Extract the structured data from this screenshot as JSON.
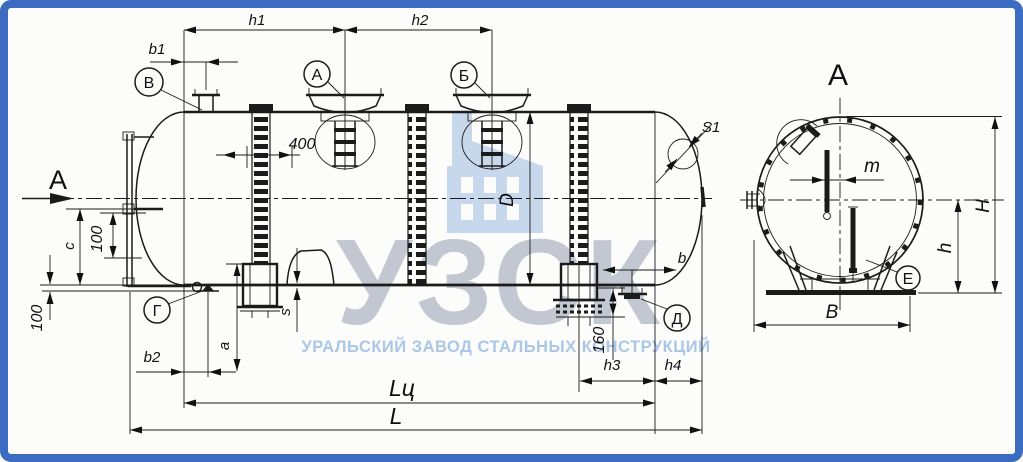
{
  "frame": {
    "border_color": "#3c6cc1",
    "background": "#fcfcfa"
  },
  "watermark": {
    "brand": "УЗСК",
    "tagline": "УРАЛЬСКИЙ ЗАВОД СТАЛЬНЫХ КОНСТРУКЦИЙ",
    "brand_color": "#c2c7d1",
    "tagline_color": "#aac7e7",
    "icon": "factory-icon",
    "icon_color": "#c8d8ec"
  },
  "side_view": {
    "section_arrow_label": "А",
    "callouts": {
      "nozzle_top": "В",
      "manhole_left": "А",
      "manhole_right": "Б",
      "fitting_bottom_left": "Г",
      "fitting_bottom_right": "Д"
    },
    "dims": {
      "h1": "h1",
      "h2": "h2",
      "b1": "b1",
      "b2": "b2",
      "n400": "400",
      "n100_gauge": "100",
      "n100_bottom": "100",
      "n160": "160",
      "D": "D",
      "c": "c",
      "a": "a",
      "s": "s",
      "S1": "S1",
      "h3": "h3",
      "h4": "h4",
      "b": "b",
      "Lc": "Lц",
      "L": "L"
    }
  },
  "section_view": {
    "title": "А",
    "callout_support": "Е",
    "dims": {
      "m": "m",
      "H": "H",
      "h": "h",
      "B": "B"
    }
  }
}
